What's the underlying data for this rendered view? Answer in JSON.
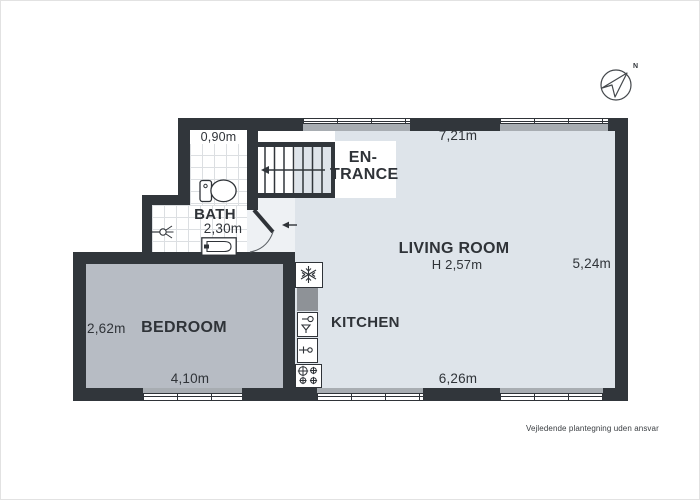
{
  "labels": {
    "entrance_line1": "EN-",
    "entrance_line2": "TRANCE",
    "bath": "BATH",
    "living_room": "LIVING ROOM",
    "living_room_ceiling": "H 2,57m",
    "bedroom": "BEDROOM",
    "kitchen": "KITCHEN"
  },
  "dimensions": {
    "bath_entry_width": "0,90m",
    "bath_width": "2,30m",
    "living_top_width": "7,21m",
    "living_right_depth": "5,24m",
    "living_bottom_width": "6,26m",
    "bedroom_left_depth": "2,62m",
    "bedroom_bottom_width": "4,10m"
  },
  "compass": {
    "north": "N"
  },
  "footer": {
    "disclaimer": "Vejledende plantegning uden ansvar"
  },
  "icons": {
    "compass": "compass-north-arrow",
    "stairs": "staircase-with-up-arrow",
    "entry_arrow": "entry-direction-arrow",
    "door": "door-swing-arc",
    "toilet": "toilet",
    "shower": "shower-head",
    "bath_sink": "washbasin",
    "fridge": "refrigerator-snowflake",
    "kitchen_sink": "kitchen-sink",
    "dishwasher": "dishwasher",
    "stove": "stove-4-burners"
  },
  "colors": {
    "wall": "#31363b",
    "living_floor": "#dee4ea",
    "bedroom_floor": "#b7bcc4",
    "hall_floor": "#eef1f4",
    "entrance_floor": "#ffffff",
    "counter": "#8e9297",
    "window_sill": "#a8adb2",
    "text": "#2f3338"
  }
}
